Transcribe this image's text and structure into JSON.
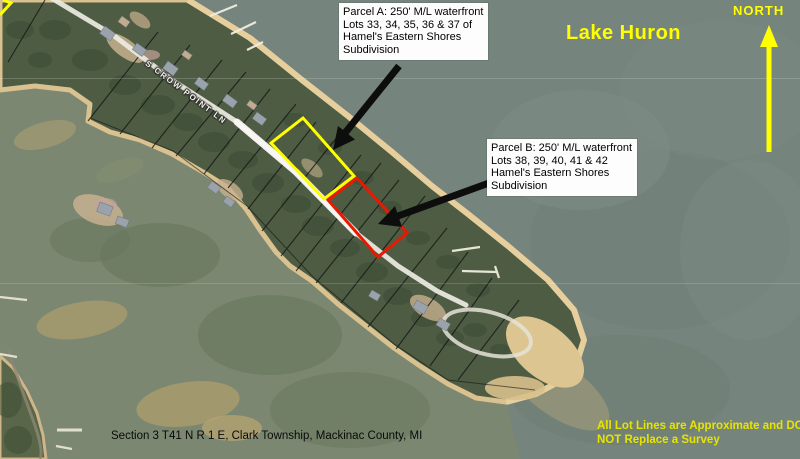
{
  "labels": {
    "lake": "Lake Huron",
    "north": "NORTH",
    "street": "S CROW POINT LN",
    "section": "Section 3 T41 N R 1 E, Clark Township, Mackinac County, MI",
    "disclaimer_line1": "All Lot Lines are Approximate and DO",
    "disclaimer_line2": "NOT Replace a Survey"
  },
  "parcel_a": {
    "line1": "Parcel A: 250' M/L waterfront",
    "line2": "Lots 33, 34, 35, 36 & 37 of",
    "line3": "Hamel's Eastern Shores",
    "line4": "Subdivision",
    "outline_color": "#ffff00"
  },
  "parcel_b": {
    "line1": "Parcel B: 250' M/L waterfront",
    "line2": "Lots 38, 39, 40, 41 & 42",
    "line3": "Hamel's Eastern Shores",
    "line4": "Subdivision",
    "outline_color": "#ea1800"
  },
  "colors": {
    "label_yellow": "#ffff00",
    "disclaimer_yellow": "#e8e400",
    "lake_water": "#75847d",
    "bay_water": "#7b8770",
    "sand": "#e0c997",
    "trees": "#4d5c43",
    "road": "#edebe3",
    "lot_line": "#141414",
    "arrow_black": "#0d0d0d",
    "callout_background": "#fdfdfd"
  }
}
